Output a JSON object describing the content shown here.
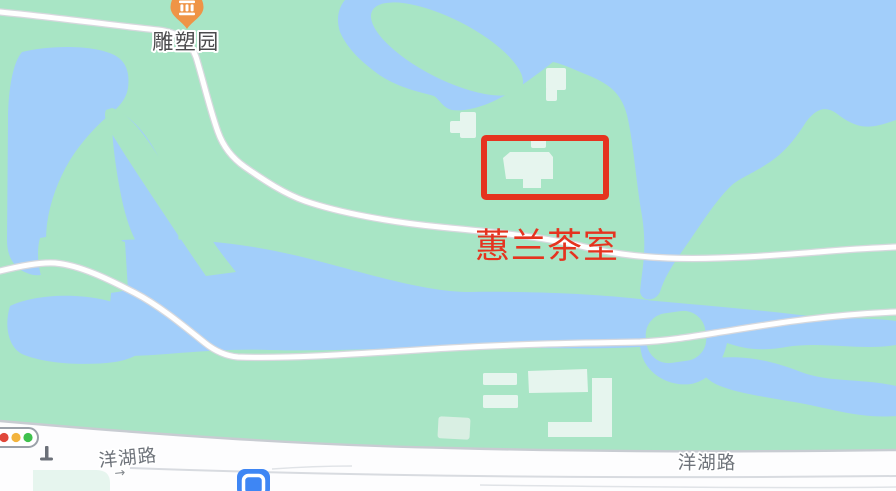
{
  "map": {
    "poi": {
      "label": "雕塑园",
      "icon": "museum-pin-icon"
    },
    "annotation": {
      "label": "蕙兰茶室",
      "shape": "red-rectangle"
    },
    "roads": {
      "bottom_left_label": "洋湖路",
      "bottom_right_label": "洋湖路",
      "direction_arrow": "→"
    },
    "icons": {
      "poi_pin": "museum-pin-icon",
      "traffic": "traffic-light-icon",
      "station": "metro-station-icon"
    }
  },
  "colors": {
    "park_green": "#a8e5c5",
    "water_blue": "#a2cefa",
    "building_fill": "#e6f5ee",
    "road_fill": "#ffffff",
    "road_casing": "#d6d8dd",
    "road_label_gray": "#6e737a",
    "poi_label_gray": "#4b4b4d",
    "annotation_red": "#e5331f",
    "pin_orange": "#ef9446",
    "traffic_red": "#e0473a",
    "traffic_yellow": "#f3b43e",
    "traffic_green": "#3fc14d",
    "metro_blue": "#3e86f4"
  }
}
